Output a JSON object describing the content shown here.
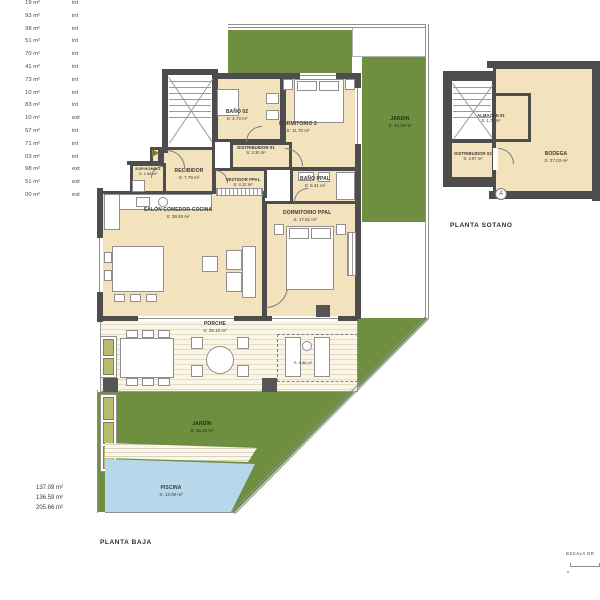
{
  "colors": {
    "wall": "#4d4d4d",
    "floor": "#f2e3bd",
    "garden": "#6d8f3f",
    "pool": "#b7d7ea",
    "planter": "#b9bc6f"
  },
  "area_table": {
    "rows": [
      {
        "value": "19 m²",
        "type": "int"
      },
      {
        "value": "93 m²",
        "type": "int"
      },
      {
        "value": "98 m²",
        "type": "int"
      },
      {
        "value": "51 m²",
        "type": "int"
      },
      {
        "value": "70 m²",
        "type": "int"
      },
      {
        "value": "41 m²",
        "type": "int"
      },
      {
        "value": "73 m²",
        "type": "int"
      },
      {
        "value": "10 m²",
        "type": "int"
      },
      {
        "value": "83 m²",
        "type": "int"
      },
      {
        "value": "10 m²",
        "type": "ext"
      },
      {
        "value": "57 m²",
        "type": "int"
      },
      {
        "value": "71 m²",
        "type": "int"
      },
      {
        "value": "03 m²",
        "type": "int"
      },
      {
        "value": "98 m²",
        "type": "ext"
      },
      {
        "value": "51 m²",
        "type": "ext"
      },
      {
        "value": "00 m²",
        "type": "ext"
      }
    ],
    "totals": [
      "137.09 m²",
      "136.59 m²",
      "205.66 m²"
    ]
  },
  "planta_baja": {
    "title": "PLANTA BAJA",
    "rooms": {
      "recibidor": {
        "name": "RECIBIDOR",
        "area": "S: 7.78 m²"
      },
      "esp": {
        "name": "ESP.HOMB.2",
        "area": "S: 1.88 m²"
      },
      "bano02": {
        "name": "BAÑO 02",
        "area": "S: 4.73 m²"
      },
      "dormitorio2": {
        "name": "DORMITORIO 2",
        "area": "S: 11.70 m²"
      },
      "distribuidor01": {
        "name": "DISTRIBUIDOR 01",
        "area": "S: 3.30 m²"
      },
      "vestidor": {
        "name": "VESTIDOR PPAL",
        "area": "S: 4.12 m²"
      },
      "banoppal": {
        "name": "BAÑO PPAL",
        "area": "S: 5.41 m²"
      },
      "salon": {
        "name": "SALÓN COMEDOR-COCINA",
        "area": "S: 39.93 m²"
      },
      "dormppal": {
        "name": "DORMITORIO PPAL",
        "area": "S: 17.51 m²"
      },
      "porche": {
        "name": "PORCHE",
        "area": "S: 38.10 m²"
      },
      "jardin_lateral": {
        "name": "JARDIN",
        "area": "S: 34.29 m²"
      },
      "jardin": {
        "name": "JARDÍN",
        "area": "S: 46.22 m²"
      },
      "piscina": {
        "name": "PISCINA",
        "area": "S: 13.00 m²"
      }
    },
    "porche_zone_area": "S: 8.88 m²"
  },
  "planta_sotano": {
    "title": "PLANTA SOTANO",
    "rooms": {
      "almacen": {
        "name": "ALMACÉN 01",
        "area": "S: 1.77 m²"
      },
      "distribuidor02": {
        "name": "DISTRIBUIDOR 02",
        "area": "S: 2.87 m²"
      },
      "bodega": {
        "name": "BODEGA",
        "area": "S: 37.03 m²"
      }
    },
    "marker": "A"
  },
  "scale_bar": {
    "label": "ESCALA GR",
    "zero": "0"
  }
}
